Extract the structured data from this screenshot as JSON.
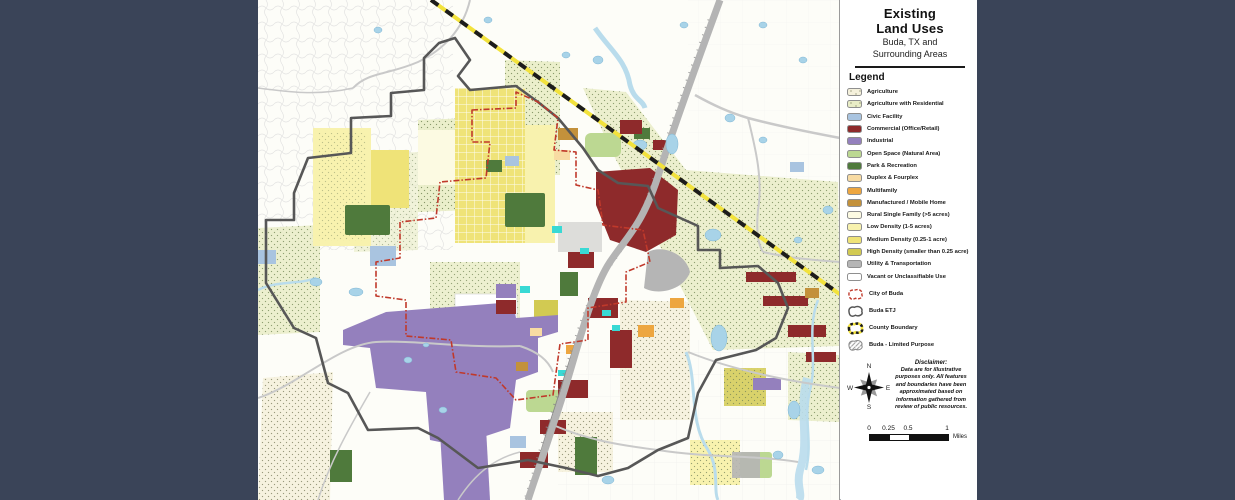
{
  "window": {
    "frame_color": "#3a4458"
  },
  "title_block": {
    "title_line1": "Existing",
    "title_line2": "Land Uses",
    "subtitle_line1": "Buda, TX and",
    "subtitle_line2": "Surrounding Areas"
  },
  "legend": {
    "heading": "Legend",
    "items": [
      {
        "key": "agriculture",
        "label": "Agriculture",
        "color": "#f5f1dc",
        "dotted": true
      },
      {
        "key": "agri_res",
        "label": "Agriculture with Residential",
        "color": "#e9edc6",
        "dotted": true
      },
      {
        "key": "civic",
        "label": "Civic Facility",
        "color": "#a9c4e0",
        "dotted": false
      },
      {
        "key": "commercial",
        "label": "Commercial (Office/Retail)",
        "color": "#8e2a2b",
        "dotted": false
      },
      {
        "key": "industrial",
        "label": "Industrial",
        "color": "#9480bd",
        "dotted": false
      },
      {
        "key": "open_space",
        "label": "Open Space (Natural Area)",
        "color": "#bcd892",
        "dotted": false
      },
      {
        "key": "park",
        "label": "Park & Recreation",
        "color": "#4f7a3c",
        "dotted": false
      },
      {
        "key": "duplex",
        "label": "Duplex & Fourplex",
        "color": "#f8dba3",
        "dotted": false
      },
      {
        "key": "multifamily",
        "label": "Multifamily",
        "color": "#eda640",
        "dotted": false
      },
      {
        "key": "manufactured",
        "label": "Manufactured / Mobile Home",
        "color": "#c3913b",
        "dotted": false
      },
      {
        "key": "rural_sf",
        "label": "Rural Single Family (>5 acres)",
        "color": "#fcfae2",
        "dotted": false
      },
      {
        "key": "low_density",
        "label": "Low Density (1-5 acres)",
        "color": "#f8f2ae",
        "dotted": false
      },
      {
        "key": "med_density",
        "label": "Medium Density (0.25-1 acre)",
        "color": "#efe378",
        "dotted": false
      },
      {
        "key": "high_density",
        "label": "High Density (smaller than 0.25 acre)",
        "color": "#d2ca52",
        "dotted": false
      },
      {
        "key": "utility",
        "label": "Utility & Transportation",
        "color": "#b5b5b5",
        "dotted": false
      },
      {
        "key": "vacant",
        "label": "Vacant or Unclassifiable Use",
        "color": "#ffffff",
        "dotted": false
      }
    ],
    "boundary_items": [
      {
        "type": "city",
        "label": "City of Buda"
      },
      {
        "type": "etj",
        "label": "Buda ETJ"
      },
      {
        "type": "county",
        "label": "County Boundary"
      },
      {
        "type": "limited",
        "label": "Buda - Limited Purpose"
      }
    ]
  },
  "compass": {
    "n": "N",
    "e": "E",
    "s": "S",
    "w": "W"
  },
  "disclaimer": {
    "heading": "Disclaimer:",
    "body": "Data are for illustrative purposes only.  All features and boundaries have been approximated based on information gathered from review of public resources."
  },
  "scale_bar": {
    "ticks": [
      "0",
      "0.25",
      "0.5",
      "1"
    ],
    "unit": "Miles"
  },
  "map": {
    "colors": {
      "water": "#a8d3e8",
      "creek": "#b9dcec",
      "road": "#c9c9c9",
      "highway": "#b4b4b4",
      "rail": "#8a8a8a",
      "city_boundary": "#c0392b",
      "etj_boundary": "#575757",
      "county_yellow": "#f2e23c",
      "county_black": "#1c1c1c"
    }
  }
}
